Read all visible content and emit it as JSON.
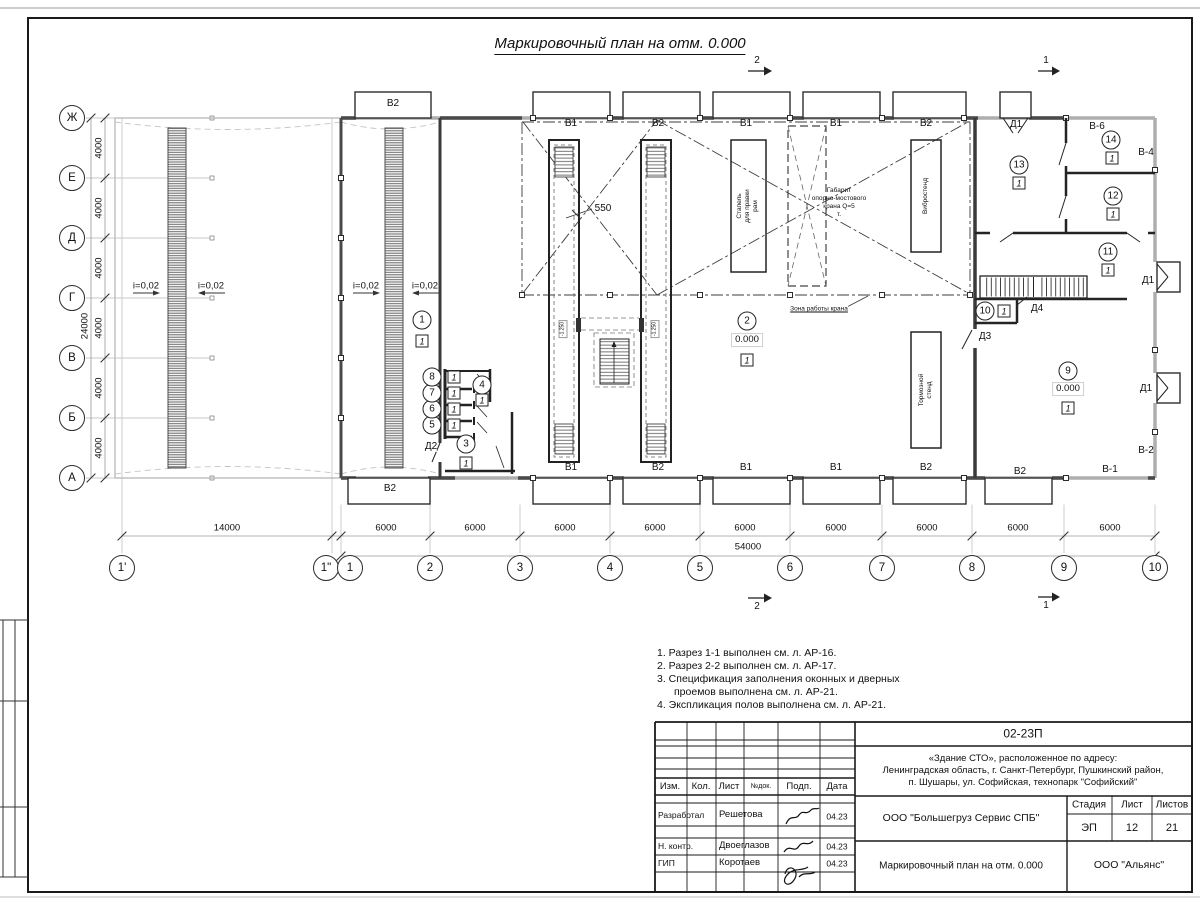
{
  "title": "Маркировочный план на отм. 0.000",
  "sections": {
    "s1": "1",
    "s2": "2"
  },
  "axes": {
    "rows": [
      "Ж",
      "Е",
      "Д",
      "Г",
      "В",
      "Б",
      "А"
    ],
    "cols": [
      "1'",
      "1\"",
      "1",
      "2",
      "3",
      "4",
      "5",
      "6",
      "7",
      "8",
      "9",
      "10"
    ],
    "dim_row": "4000",
    "dim_row_total": "24000",
    "dim_col_first": "14000",
    "dim_col": "6000",
    "dim_col_total": "54000"
  },
  "plan": {
    "slope": "i=0,02",
    "dim_550": "550",
    "pit_elev": "-1.250",
    "elev_zero": "0.000",
    "floor_type": "1",
    "crane_zone": "Зона работы крана",
    "gabarit": "Габарит\nопорно-мостового\nкрана Q=5\nт.",
    "equip_stapel": "Стапель\nдля правки\nрам",
    "equip_vibro": "Вибростенд",
    "equip_tormoz": "Тормозной\nстенд",
    "win": {
      "b1": "В1",
      "b2": "В2",
      "b6": "В-6",
      "b4": "В-4",
      "b2d": "В-2",
      "b1d": "В-1"
    },
    "doors": {
      "d1": "Д1",
      "d2": "Д2",
      "d3": "Д3",
      "d4": "Д4"
    },
    "rooms": {
      "r1": "1",
      "r2": "2",
      "r3": "3",
      "r4": "4",
      "r5": "5",
      "r6": "6",
      "r7": "7",
      "r8": "8",
      "r9": "9",
      "r10": "10",
      "r11": "11",
      "r12": "12",
      "r13": "13",
      "r14": "14"
    }
  },
  "notes": [
    "1. Разрез 1-1 выполнен см. л. АР-16.",
    "2. Разрез 2-2 выполнен см. л. АР-17.",
    "3. Спецификация заполнения оконных и дверных",
    "проемов выполнена см. л. АР-21.",
    "4. Экспликация полов выполнена см. л. АР-21."
  ],
  "titleblock": {
    "doc_number": "02-23П",
    "address": "«Здание СТО», расположенное по адресу:\nЛенинградская область, г. Санкт-Петербург, Пушкинский район,\nп. Шушары, ул. Софийская, технопарк \"Софийский\"",
    "cols": [
      "Изм.",
      "Кол.",
      "Лист",
      "№док.",
      "Подп.",
      "Дата"
    ],
    "rows": [
      {
        "role": "Разработал",
        "name": "Решетова",
        "date": "04.23"
      },
      {
        "role": "Н. контр.",
        "name": "Двоеглазов",
        "date": "04.23"
      },
      {
        "role": "ГИП",
        "name": "Коротаев",
        "date": "04.23"
      }
    ],
    "company": "ООО \"Большегруз Сервис СПБ\"",
    "stage_label": "Стадия",
    "sheet_label": "Лист",
    "sheets_label": "Листов",
    "stage": "ЭП",
    "sheet": "12",
    "sheets": "21",
    "doc_title": "Маркировочный план на отм. 0.000",
    "org": "ООО \"Альянс\""
  }
}
